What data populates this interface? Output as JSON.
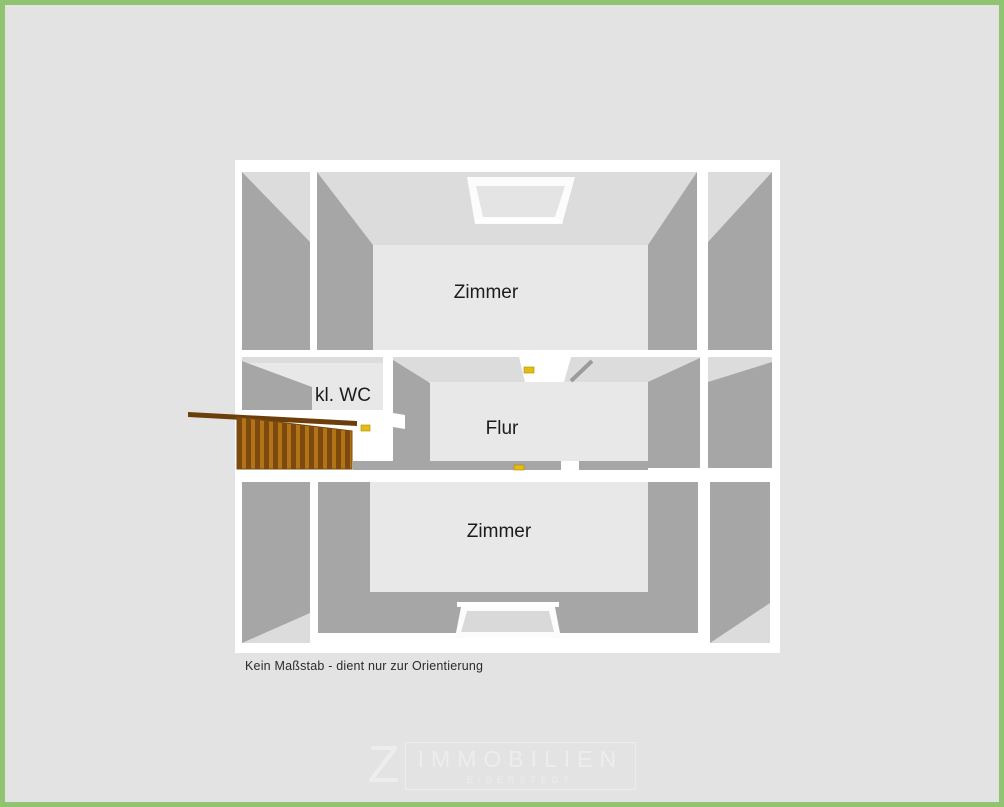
{
  "page": {
    "type": "floorplan-image",
    "colors": {
      "page_background": "#e3e3e3",
      "frame_green": "#90c471",
      "plan_background": "#ffffff",
      "wall_face_dark": "#a6a6a6",
      "wall_face_light": "#dcdcdc",
      "floor": "#e8e8e8",
      "stairs_dark": "#7c4a10",
      "stairs_light": "#b27415",
      "door_handle_yellow": "#e6bc13"
    }
  },
  "floorplan": {
    "rooms": [
      {
        "name": "zimmer-top",
        "label": "Zimmer"
      },
      {
        "name": "wc",
        "label": "kl. WC"
      },
      {
        "name": "flur",
        "label": "Flur"
      },
      {
        "name": "zimmer-bottom",
        "label": "Zimmer"
      }
    ],
    "features": [
      {
        "name": "staircase"
      },
      {
        "name": "skylight-top"
      },
      {
        "name": "skylight-bottom"
      },
      {
        "name": "door-handle",
        "count": 3
      },
      {
        "name": "open-door-leaf"
      }
    ],
    "disclaimer": "Kein Maßstab - dient nur zur Orientierung"
  },
  "logo": {
    "letter": "Z",
    "name": "IMMOBILIEN",
    "subtitle": "EIDERSTEDT"
  }
}
